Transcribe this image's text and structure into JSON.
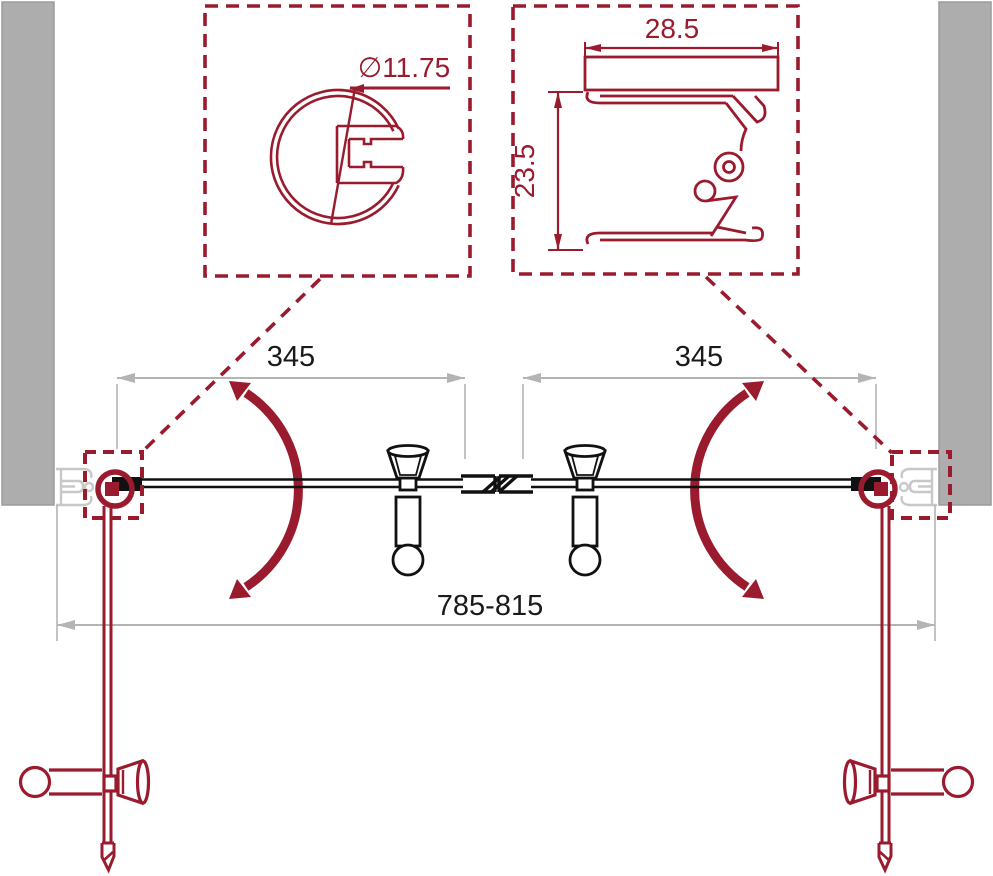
{
  "drawing": {
    "title": "shower-door-technical-drawing",
    "detail_round_profile": {
      "diameter_label": "∅11.75"
    },
    "detail_wall_profile": {
      "width_label": "28.5",
      "height_label": "23.5"
    },
    "plan_view": {
      "left_door_width_label": "345",
      "right_door_width_label": "345",
      "overall_width_label": "785-815"
    },
    "colors": {
      "line_red": "#9A1B2E",
      "ink_black": "#111111",
      "dim_gray": "#B4B4B4",
      "wall_gray": "#ADADAD",
      "profile_gray": "#C8C8C8"
    }
  }
}
